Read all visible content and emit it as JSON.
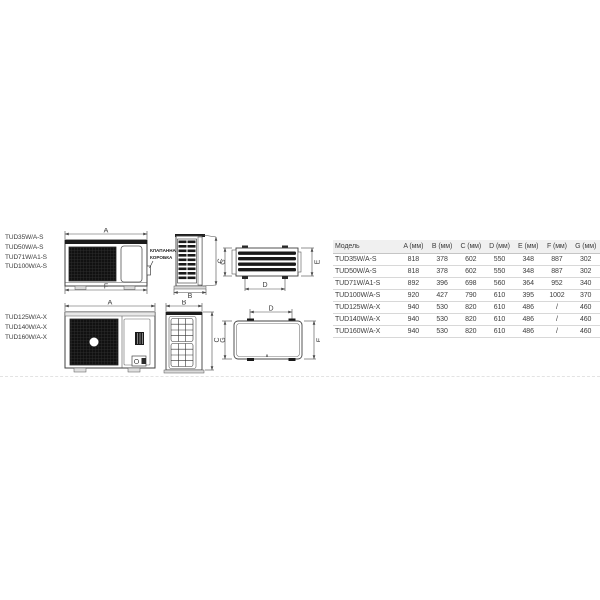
{
  "labels": {
    "group1": [
      "TUD35W/A-S",
      "TUD50W/A-S",
      "TUD71W/A1-S",
      "TUD100W/A-S"
    ],
    "group2": [
      "TUD125W/A-X",
      "TUD140W/A-X",
      "TUD160W/A-X"
    ]
  },
  "callout": {
    "line1": "КЛАПАННАЯ",
    "line2": "КОРОБКА"
  },
  "dims": {
    "A": "A",
    "B": "B",
    "C": "C",
    "D": "D",
    "E": "E",
    "F": "F",
    "G": "G"
  },
  "table": {
    "columns": [
      "Модель",
      "A (мм)",
      "B (мм)",
      "C (мм)",
      "D (мм)",
      "E (мм)",
      "F (мм)",
      "G (мм)"
    ],
    "rows": [
      [
        "TUD35W/A-S",
        "818",
        "378",
        "602",
        "550",
        "348",
        "887",
        "302"
      ],
      [
        "TUD50W/A-S",
        "818",
        "378",
        "602",
        "550",
        "348",
        "887",
        "302"
      ],
      [
        "TUD71W/A1-S",
        "892",
        "396",
        "698",
        "560",
        "364",
        "952",
        "340"
      ],
      [
        "TUD100W/A-S",
        "920",
        "427",
        "790",
        "610",
        "395",
        "1002",
        "370"
      ],
      [
        "TUD125W/A-X",
        "940",
        "530",
        "820",
        "610",
        "486",
        "/",
        "460"
      ],
      [
        "TUD140W/A-X",
        "940",
        "530",
        "820",
        "610",
        "486",
        "/",
        "460"
      ],
      [
        "TUD160W/A-X",
        "940",
        "530",
        "820",
        "610",
        "486",
        "/",
        "460"
      ]
    ]
  },
  "colors": {
    "line": "#4a4a4a",
    "dark_fill": "#141414",
    "table_header_bg": "#f0f0f0",
    "row_border": "#d8d8d8",
    "text": "#3c3c3c"
  }
}
